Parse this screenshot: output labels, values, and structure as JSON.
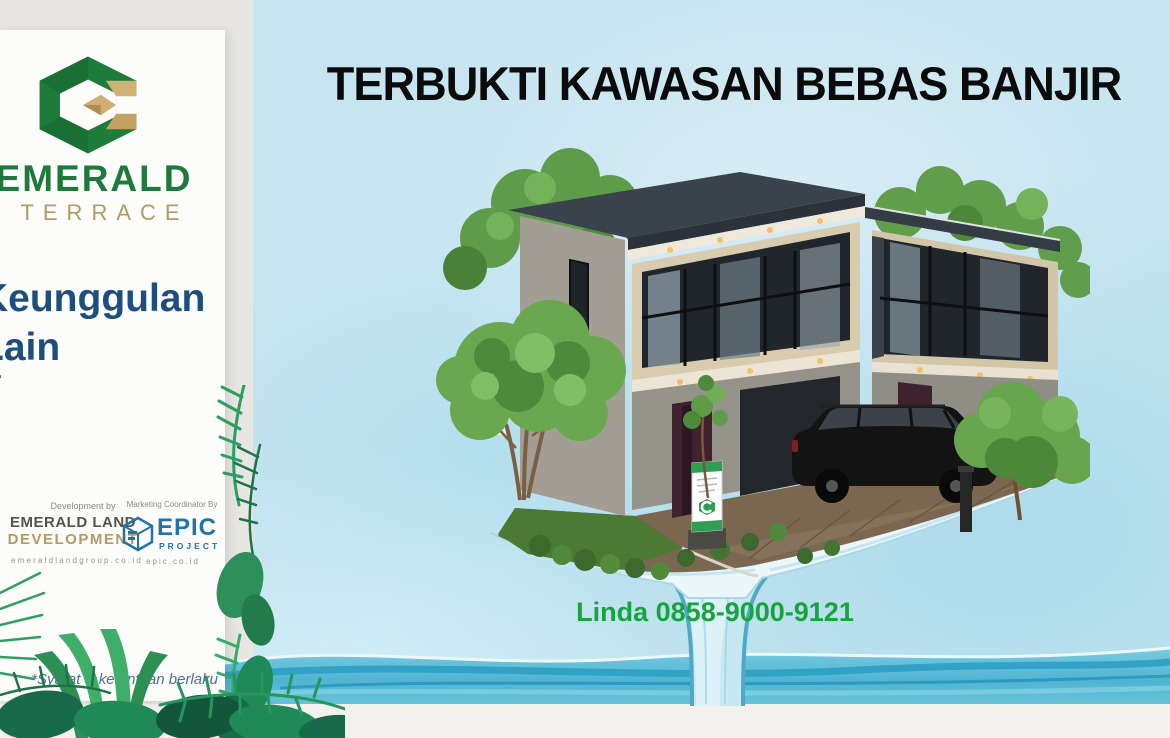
{
  "page": {
    "headline": "TERBUKTI KAWASAN BEBAS BANJIR",
    "contact": "Linda 0858-9000-9121"
  },
  "sidebar": {
    "brand": {
      "name": "EMERALD",
      "subname": "TERRACE"
    },
    "heading": {
      "line1": "Keunggulan",
      "line2": "Lain"
    },
    "list_marker": "-",
    "developer": {
      "label": "Development by",
      "line1": "EMERALD LAND",
      "line2": "DEVELOPMENT",
      "website": "emeraldlandgroup.co.id"
    },
    "marketing": {
      "label": "Marketing Coordinator By",
      "brand": "EPIC",
      "brand_sub": "PROJECT",
      "website": "epic.co.id"
    },
    "disclaimer": "*Syarat & ketentuan berlaku"
  },
  "colors": {
    "emerald_green": "#1e7a3c",
    "gold": "#b49a64",
    "heading_blue": "#1d4e80",
    "epic_blue": "#2273aa",
    "contact_green": "#17a33e",
    "sky_blue": "#c7e5f0",
    "water_blue": "#4fb4d2"
  }
}
